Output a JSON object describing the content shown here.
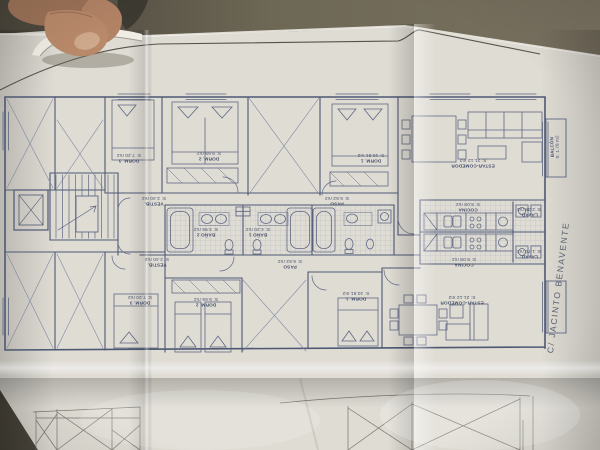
{
  "colors": {
    "background": "#6b6556",
    "paper": "#dfdcd4",
    "plan_ink": "#4e5874",
    "hand_skin": "#b3876a"
  },
  "street_label": "C/ JACINTO BENAVENTE",
  "rooms": {
    "dorm3_top": {
      "name": "DORM. 3",
      "area": "S: 7.20 m2"
    },
    "dorm2_top": {
      "name": "DORM. 2",
      "area": "S: 9.65 m2"
    },
    "dorm1_top": {
      "name": "DORM. 1",
      "area": "S: 10.91 m2"
    },
    "estar_top": {
      "name": "ESTAR-COMEDOR",
      "area": "S: 21.12 m2"
    },
    "balcon_top": {
      "name": "BALCÓN",
      "area": "S: 1.78 m2"
    },
    "paso_top": {
      "name": "PASO",
      "area": "S: 6.52 m2"
    },
    "vestib_top": {
      "name": "VESTIB.",
      "area": "S: 2.40 m2"
    },
    "bano2_top": {
      "name": "BAÑO 2",
      "area": "S: 3.96 m2"
    },
    "bano1_top": {
      "name": "BAÑO 1",
      "area": "S: 4.20 m2"
    },
    "cocina_top": {
      "name": "COCINA",
      "area": "S: 8.08 m2"
    },
    "lavad_top": {
      "name": "LAVAD.",
      "area": "S: 2.38 m2"
    },
    "vestib_bottom": {
      "name": "VESTIB.",
      "area": "S: 2.40 m2"
    },
    "paso_bottom": {
      "name": "PASO",
      "area": "S: 6.52 m2"
    },
    "cocina_bottom": {
      "name": "COCINA",
      "area": "S: 8.08 m2"
    },
    "lavad_bottom": {
      "name": "LAVAD.",
      "area": "S: 1.70 m2"
    },
    "dorm3_bottom": {
      "name": "DORM. 3",
      "area": "S: 7.20 m2"
    },
    "dorm2_bottom": {
      "name": "DORM. 2",
      "area": "S: 9.65 m2"
    },
    "dorm1_bottom": {
      "name": "DORM. 1",
      "area": "S: 10.91 m2"
    },
    "estar_bottom": {
      "name": "ESTAR-COMEDOR",
      "area": "S: 21.12 m2"
    }
  }
}
